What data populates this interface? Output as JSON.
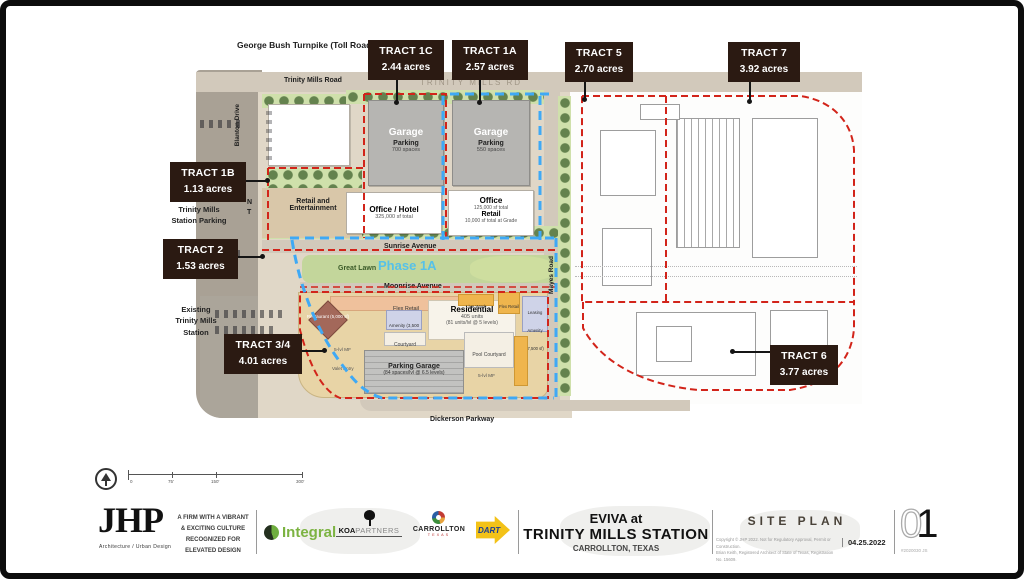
{
  "map": {
    "turnpike": "George Bush Turnpike (Toll Road)",
    "roads": {
      "trinity_mills": "Trinity Mills Road",
      "trinity_mills_rd": "TRINITY MILLS RD",
      "blanton": "Blanton Drive",
      "mayes": "Mayes Road",
      "sunrise": "Sunrise Avenue",
      "moonrise": "Moonrise Avenue",
      "dickerson": "Dickerson Parkway"
    },
    "labels": {
      "station_parking_1": "Trinity Mills",
      "station_parking_2": "Station Parking",
      "existing_1": "Existing",
      "existing_2": "Trinity Mills",
      "existing_3": "Station",
      "n": "N",
      "t": "T",
      "great_lawn": "Great Lawn",
      "phase": "Phase 1A"
    },
    "buildings": {
      "garage1_title": "Garage",
      "garage1_sub": "Parking",
      "garage1_detail": "700 spaces",
      "garage2_title": "Garage",
      "garage2_sub": "Parking",
      "garage2_detail": "550 spaces",
      "office_hotel_title": "Office / Hotel",
      "office_hotel_detail": "325,000 sf total",
      "office_title": "Office",
      "office_detail": "125,000 sf total",
      "office_retail_title": "Retail",
      "office_retail_detail": "10,000 sf total at Grade",
      "retail_ent": "Retail and Entertainment",
      "flex_retail": "Flex Retail",
      "restaurant": "Restaurant (5,000 sf)",
      "amenity": "Amenity (3,500 sf)",
      "courtyard": "Courtyard",
      "residential_title": "Residential",
      "residential_d1": "405 units",
      "residential_d2": "(81 units/lvl @ 5 levels)",
      "live_work": "Live Work",
      "flex_retail2": "Flex Retail",
      "leasing": "Leasing Amenity (7,500 sf)",
      "pool": "Pool Courtyard",
      "pgarage_title": "Parking Garage",
      "pgarage_detail": "(84 spaces/lvl @ 6.5 levels)",
      "mf1": "5-lvl MF",
      "mf2": "5-lvl MF",
      "valet": "Valet Entry"
    }
  },
  "tracts": [
    {
      "name": "TRACT 1C",
      "acres": "2.44 acres"
    },
    {
      "name": "TRACT 1A",
      "acres": "2.57 acres"
    },
    {
      "name": "TRACT 5",
      "acres": "2.70 acres"
    },
    {
      "name": "TRACT 7",
      "acres": "3.92 acres"
    },
    {
      "name": "TRACT 1B",
      "acres": "1.13 acres"
    },
    {
      "name": "TRACT 2",
      "acres": "1.53 acres"
    },
    {
      "name": "TRACT 3/4",
      "acres": "4.01 acres"
    },
    {
      "name": "TRACT 6",
      "acres": "3.77 acres"
    }
  ],
  "scale_bar": {
    "t0": "0",
    "t1": "75'",
    "t2": "150'",
    "t3": "300'"
  },
  "footer": {
    "jhp": {
      "name": "JHP",
      "tagline": "Architecture / Urban Design"
    },
    "motto": {
      "l1": "A FIRM WITH A VIBRANT",
      "l2": "& EXCITING CULTURE",
      "l3": "RECOGNIZED FOR",
      "l4": "ELEVATED DESIGN"
    },
    "partners": {
      "integral": "Integral",
      "koa": "KOA",
      "koa2": "PARTNERS",
      "carrollton": "CARROLLTON",
      "carrollton_sub": "TEXAS",
      "dart": "DART"
    },
    "title": {
      "line1": "EVIVA at",
      "line2": "TRINITY MILLS STATION",
      "line3": "CARROLLTON, TEXAS"
    },
    "sheet": {
      "name": "SITE PLAN",
      "copyright1": "Copyright © JHP 2022. Not for Regulatory Approval, Permit or Construction.",
      "copyright2": "Brian Keith, Registered Architect of State of Texas, Registration No. 15609.",
      "date": "04.25.2022"
    },
    "page": {
      "zero": "0",
      "one": "1",
      "project": "#2020030  JS"
    }
  },
  "colors": {
    "tract_box": "#2b1a12",
    "red_dash": "#d2241a",
    "blue_dash": "#3fa9f5",
    "phase_text": "#56c1e8",
    "integral_green": "#7cb342",
    "dart_yellow": "#f3c218",
    "dart_blue": "#1b3e93"
  }
}
